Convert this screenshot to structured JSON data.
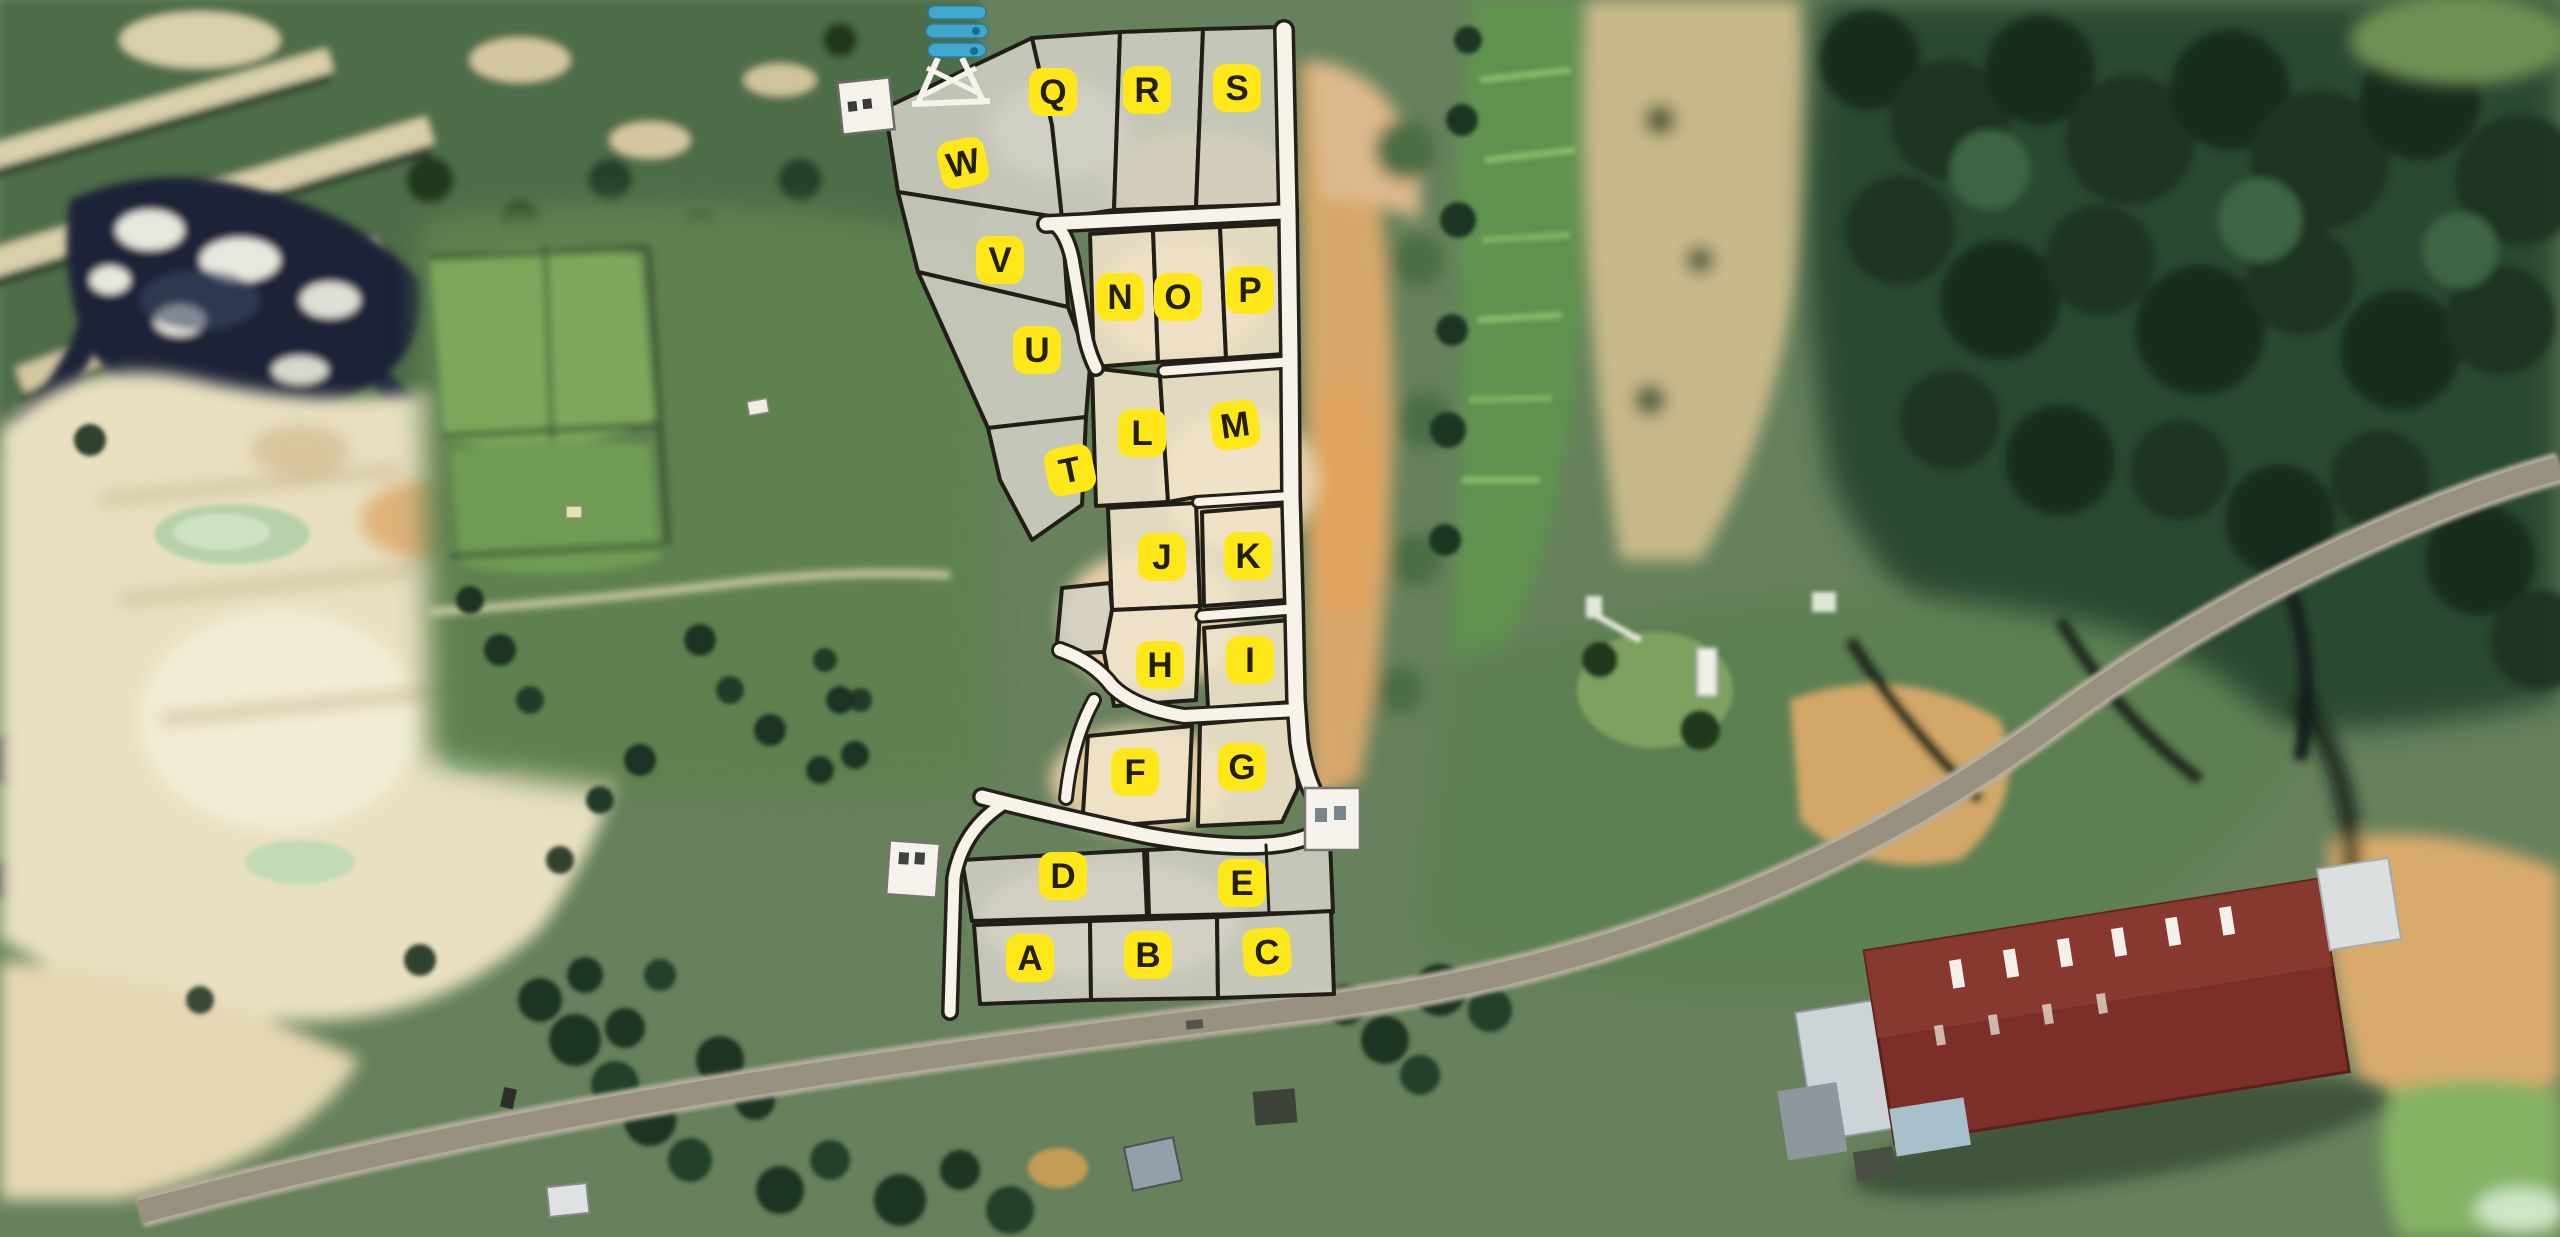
{
  "map": {
    "type": "satellite-plot-subdivision-map",
    "marker_style": {
      "fill": "#ffe719",
      "text_color": "#231f04",
      "size": 48,
      "radius": 13,
      "font_size": 35
    },
    "palette": {
      "parcel_fill": "#e7ddc7",
      "parcel_fill_gray": "#d4d2c6",
      "boundary": "#211e18",
      "road_fill": "#f7f3e9",
      "terrain_green": "#66815c",
      "forest_dark": "#2b4831",
      "quarry_sand": "#e8e0c1",
      "dirt_orange": "#d6a76a",
      "asphalt_road": "#99917f",
      "pond_green": "#b7d2ab",
      "rock_navy": "#1d2339",
      "warehouse_roof_red": "#7c2f28",
      "structure_white": "#f5f3ec",
      "water_tank_blue": "#3fa8cc"
    },
    "plot_markers": [
      {
        "letter": "Q",
        "x": 1053,
        "y": 92,
        "rot": 0
      },
      {
        "letter": "R",
        "x": 1147,
        "y": 90,
        "rot": 0
      },
      {
        "letter": "S",
        "x": 1237,
        "y": 88,
        "rot": 0
      },
      {
        "letter": "W",
        "x": 963,
        "y": 163,
        "rot": -12
      },
      {
        "letter": "V",
        "x": 1000,
        "y": 260,
        "rot": 0
      },
      {
        "letter": "U",
        "x": 1037,
        "y": 350,
        "rot": 0
      },
      {
        "letter": "N",
        "x": 1120,
        "y": 297,
        "rot": 0
      },
      {
        "letter": "O",
        "x": 1178,
        "y": 297,
        "rot": 0
      },
      {
        "letter": "P",
        "x": 1250,
        "y": 290,
        "rot": 0
      },
      {
        "letter": "L",
        "x": 1142,
        "y": 433,
        "rot": 0
      },
      {
        "letter": "M",
        "x": 1235,
        "y": 425,
        "rot": -8
      },
      {
        "letter": "T",
        "x": 1070,
        "y": 470,
        "rot": -12
      },
      {
        "letter": "J",
        "x": 1162,
        "y": 557,
        "rot": 0
      },
      {
        "letter": "K",
        "x": 1248,
        "y": 556,
        "rot": 0
      },
      {
        "letter": "H",
        "x": 1160,
        "y": 665,
        "rot": 0
      },
      {
        "letter": "I",
        "x": 1250,
        "y": 660,
        "rot": 0
      },
      {
        "letter": "F",
        "x": 1135,
        "y": 772,
        "rot": 0
      },
      {
        "letter": "G",
        "x": 1242,
        "y": 767,
        "rot": 0
      },
      {
        "letter": "D",
        "x": 1063,
        "y": 876,
        "rot": 0
      },
      {
        "letter": "E",
        "x": 1242,
        "y": 883,
        "rot": 0
      },
      {
        "letter": "A",
        "x": 1030,
        "y": 958,
        "rot": 0
      },
      {
        "letter": "B",
        "x": 1148,
        "y": 955,
        "rot": 0
      },
      {
        "letter": "C",
        "x": 1267,
        "y": 952,
        "rot": -4
      }
    ],
    "parcels": [
      {
        "id": "W",
        "tone": "tone-a",
        "points": "885,108 1032,38 1052,125 1062,218 898,192"
      },
      {
        "id": "Q",
        "tone": "tone-a",
        "points": "1032,38 1120,32 1114,210 1062,218 1052,125"
      },
      {
        "id": "R",
        "tone": "tone-a",
        "points": "1120,32 1203,29 1196,207 1114,210"
      },
      {
        "id": "S",
        "tone": "tone-a",
        "points": "1203,29 1280,27 1286,204 1196,207"
      },
      {
        "id": "V",
        "tone": "tone-a",
        "points": "898,192 1062,218 1068,307 918,272"
      },
      {
        "id": "U",
        "tone": "tone-a",
        "points": "918,272 1068,307 1090,366 1086,417 988,428"
      },
      {
        "id": "T",
        "tone": "tone-a",
        "points": "988,428 1086,417 1082,505 1032,540 1000,480"
      },
      {
        "id": "N",
        "tone": "tone-b",
        "points": "1090,234 1153,230 1158,362 1094,367"
      },
      {
        "id": "O",
        "tone": "tone-b",
        "points": "1153,230 1220,227 1226,358 1158,362"
      },
      {
        "id": "P",
        "tone": "tone-b",
        "points": "1220,227 1282,224 1284,354 1226,358"
      },
      {
        "id": "L",
        "tone": "tone-b",
        "points": "1092,368 1160,376 1168,502 1096,506"
      },
      {
        "id": "M",
        "tone": "tone-b",
        "points": "1160,376 1284,366 1284,492 1196,497 1168,502"
      },
      {
        "id": "J",
        "tone": "tone-b",
        "points": "1108,508 1196,503 1200,606 1112,610"
      },
      {
        "id": "K",
        "tone": "tone-b",
        "points": "1202,512 1286,505 1286,600 1204,606"
      },
      {
        "id": "X1",
        "tone": "tone-a",
        "points": "1062,588 1110,583 1112,610 1104,652 1056,654"
      },
      {
        "id": "H",
        "tone": "tone-b",
        "points": "1112,610 1200,606 1196,700 1114,706 1104,652"
      },
      {
        "id": "I",
        "tone": "tone-b",
        "points": "1204,628 1290,620 1292,702 1208,708"
      },
      {
        "id": "F",
        "tone": "tone-b",
        "points": "1088,736 1192,726 1188,820 1082,828"
      },
      {
        "id": "G",
        "tone": "tone-b",
        "points": "1200,724 1292,716 1298,788 1282,822 1198,826"
      },
      {
        "id": "D",
        "tone": "tone-a",
        "points": "962,860 1144,850 1147,916 972,921"
      },
      {
        "id": "E",
        "tone": "tone-a",
        "points": "1147,850 1330,841 1333,912 1149,916"
      },
      {
        "id": "A",
        "tone": "tone-a",
        "points": "974,925 1090,921 1091,1000 980,1004"
      },
      {
        "id": "B",
        "tone": "tone-a",
        "points": "1090,921 1217,917 1218,998 1091,1000"
      },
      {
        "id": "C",
        "tone": "tone-a",
        "points": "1217,917 1331,911 1334,994 1218,998"
      }
    ],
    "roads": [
      {
        "id": "road-top",
        "d": "M1046,224 L1282,212",
        "cw": 20,
        "fw": 13
      },
      {
        "id": "road-right",
        "d": "M1284,30 L1288,213 L1290,355 L1291,497 L1294,606 L1296,700 L1299,742 Q1306,790 1326,812 L1342,828",
        "cw": 22,
        "fw": 15
      },
      {
        "id": "road-left-inner",
        "d": "M1054,224 Q1066,232 1072,258 L1086,340 Q1090,356 1096,368",
        "cw": 18,
        "fw": 11
      },
      {
        "id": "road-mid",
        "d": "M1060,650 Q1094,662 1112,686 Q1134,708 1184,716 L1298,710",
        "cw": 18,
        "fw": 12
      },
      {
        "id": "road-stub",
        "d": "M1094,700 Q1072,740 1066,798",
        "cw": 16,
        "fw": 10
      },
      {
        "id": "road-d-row",
        "d": "M982,797 Q1056,816 1150,836 Q1235,851 1285,843 Q1312,838 1334,824",
        "cw": 20,
        "fw": 13
      },
      {
        "id": "road-west-edge",
        "d": "M1000,806 Q962,832 954,878 L950,1012",
        "cw": 18,
        "fw": 11
      },
      {
        "id": "road-strip-op",
        "d": "M1164,371 L1288,362",
        "cw": 15,
        "fw": 9
      },
      {
        "id": "road-strip-mk",
        "d": "M1198,502 L1290,496",
        "cw": 14,
        "fw": 8
      },
      {
        "id": "road-strip-ki",
        "d": "M1202,616 L1292,609",
        "cw": 15,
        "fw": 9
      }
    ],
    "extra_lines": [
      {
        "id": "e-parcel-divider",
        "d": "M1266,845 L1269,913",
        "w": 3
      }
    ],
    "structures": [
      "water-tower",
      "utility-building-north",
      "gate-house-west",
      "gate-house-east",
      "warehouse-red-roof",
      "garden-compound",
      "house-bottom-center",
      "shed-bottom-center"
    ]
  }
}
